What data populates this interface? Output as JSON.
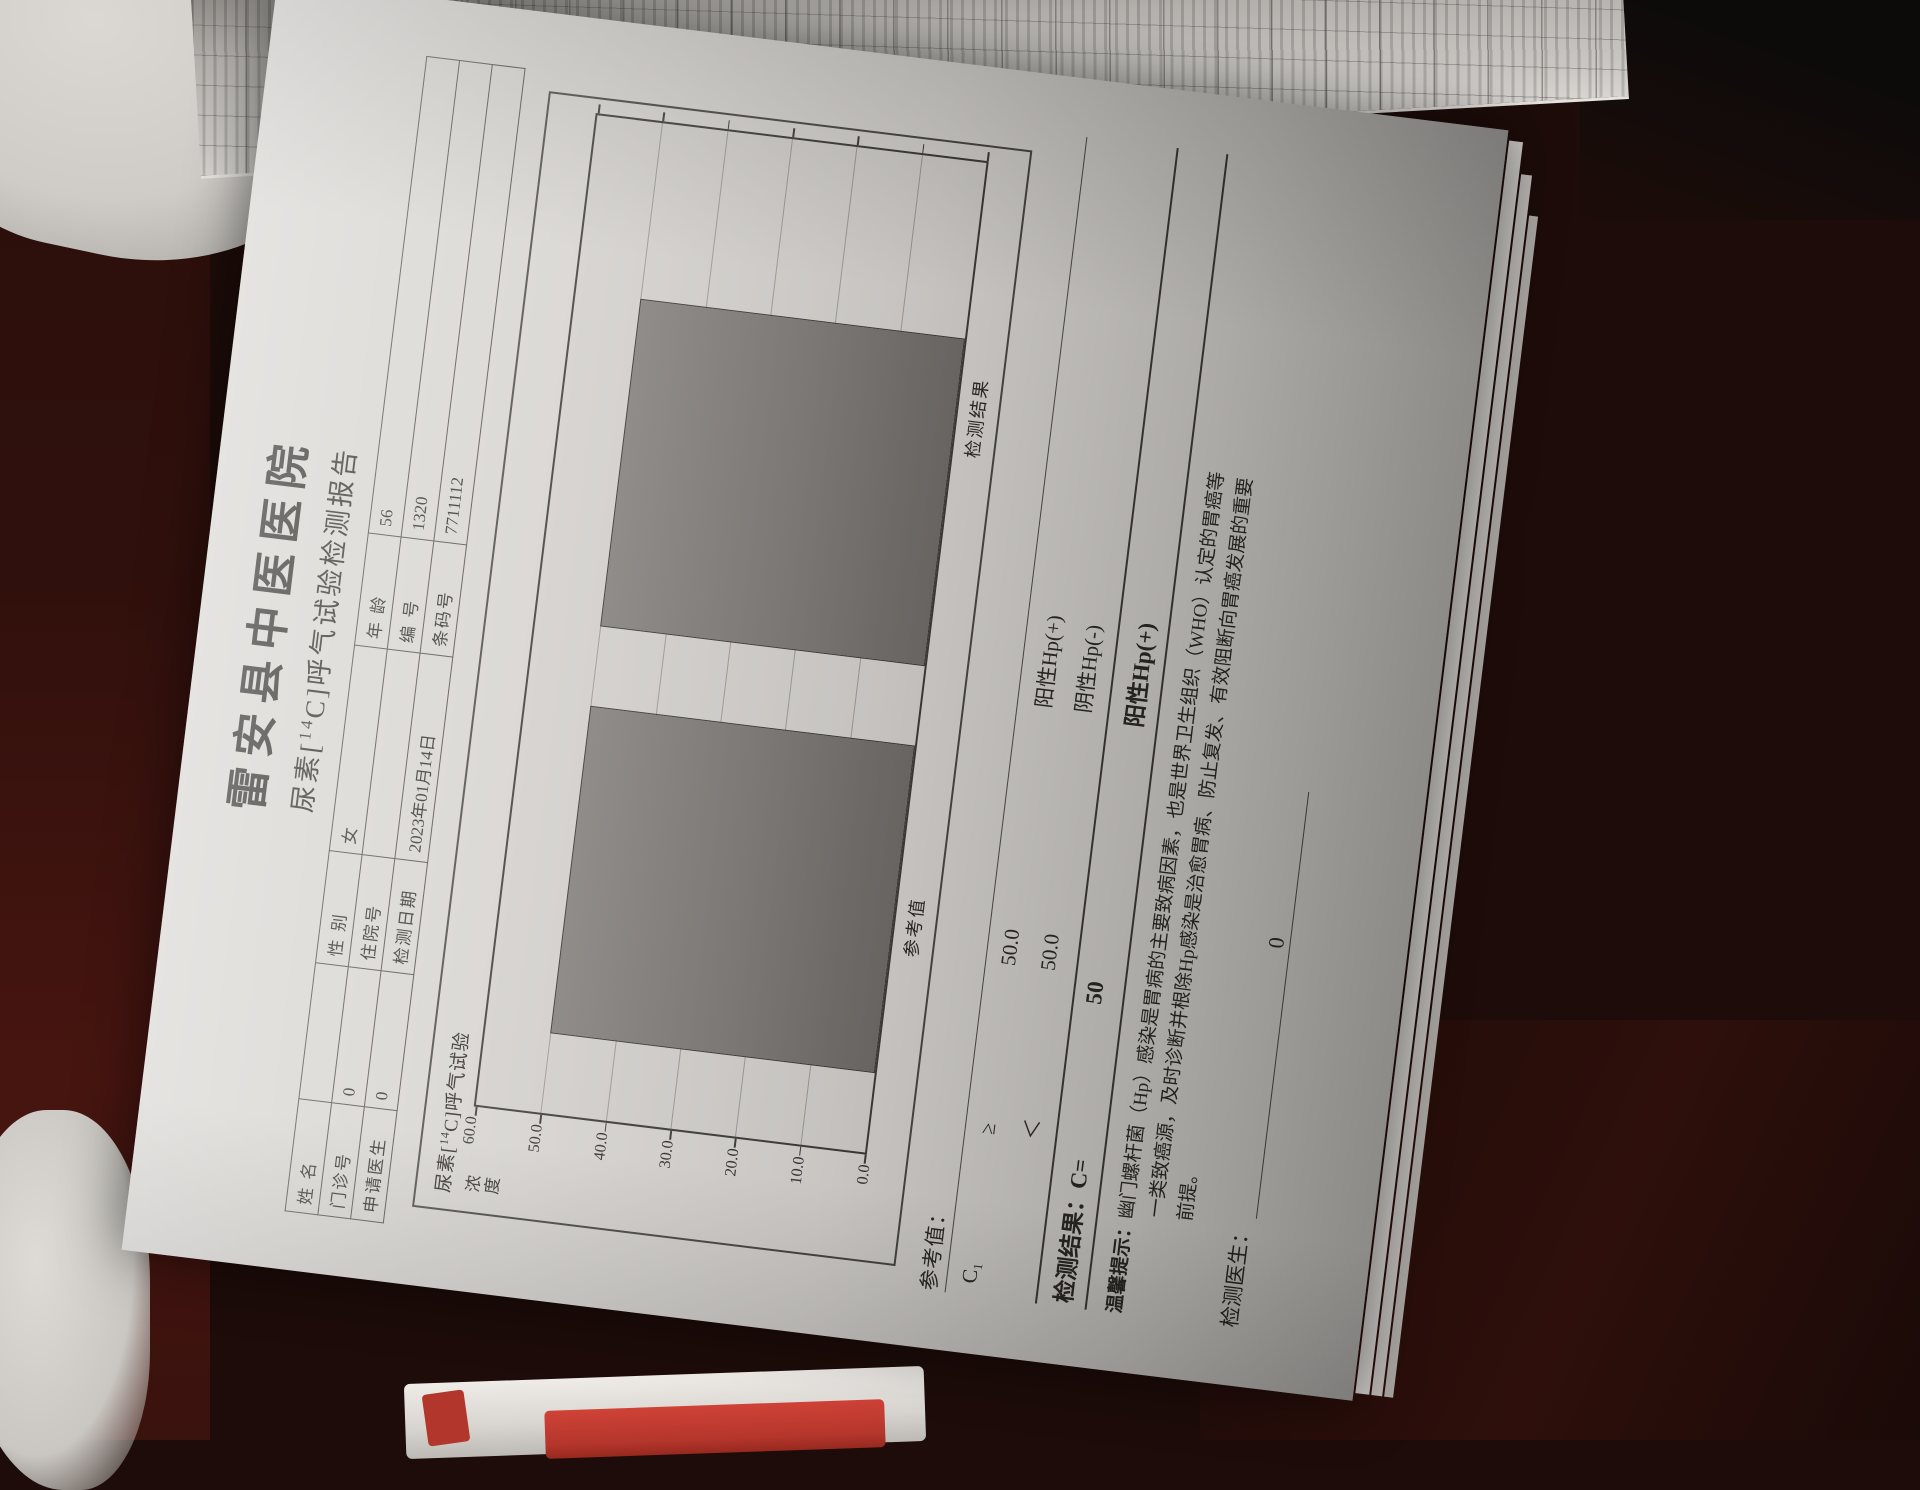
{
  "document": {
    "hospital": "雷安县中医医院",
    "subtitle": {
      "pre": "尿素[",
      "iso": "14",
      "post": "C]呼气试验检测报告"
    },
    "patient": {
      "rows": [
        {
          "l0": "姓  名",
          "v0": "",
          "l1": "性  别",
          "v1": "女",
          "l2": "年  龄",
          "v2": "56"
        },
        {
          "l0": "门诊号",
          "v0": "0",
          "l1": "住院号",
          "v1": "",
          "l2": "编  号",
          "v2": "1320"
        },
        {
          "l0": "申请医生",
          "v0": "0",
          "l1": "检测日期",
          "v1": "2023年01月14日",
          "l2": "条码号",
          "v2": "7711112"
        }
      ]
    },
    "figure_caption": {
      "pre": "尿素[",
      "iso": "14",
      "post": "C]呼气试验"
    },
    "reference": {
      "heading": "参考值：",
      "rows": [
        {
          "c": "C₁",
          "op": "≥",
          "value": "50.0",
          "conclusion": "阳性Hp(+)"
        },
        {
          "c": "",
          "op": "＜",
          "value": "50.0",
          "conclusion": "阴性Hp(-)"
        }
      ]
    },
    "result": {
      "label": "检测结果：C=",
      "value": "50",
      "conclusion": "阳性Hp(+)"
    },
    "tips": {
      "label": "温馨提示：",
      "line1": "幽门螺杆菌（Hp）感染是胃病的主要致病因素，也是世界卫生组织（WHO）认定的胃癌等",
      "line2": "一类致癌源，及时诊断并根除Hp感染是治愈胃病、防止复发、有效阻断向胃癌发展的重要",
      "line3": "前提。"
    },
    "doctor": {
      "label": "检测医生：",
      "value": "0"
    }
  },
  "chart_data": {
    "type": "bar",
    "title": "尿素[14C]呼气试验",
    "categories": [
      "参考值",
      "检测结果"
    ],
    "values": [
      50.0,
      50.0
    ],
    "xlabel": "",
    "ylabel": "浓度",
    "ylim": [
      0,
      60
    ],
    "yticks": [
      "60.0",
      "50.0",
      "40.0",
      "30.0",
      "20.0",
      "10.0",
      "0.0"
    ],
    "grid": true,
    "legend": "none",
    "bar_color": "#7b7874"
  }
}
